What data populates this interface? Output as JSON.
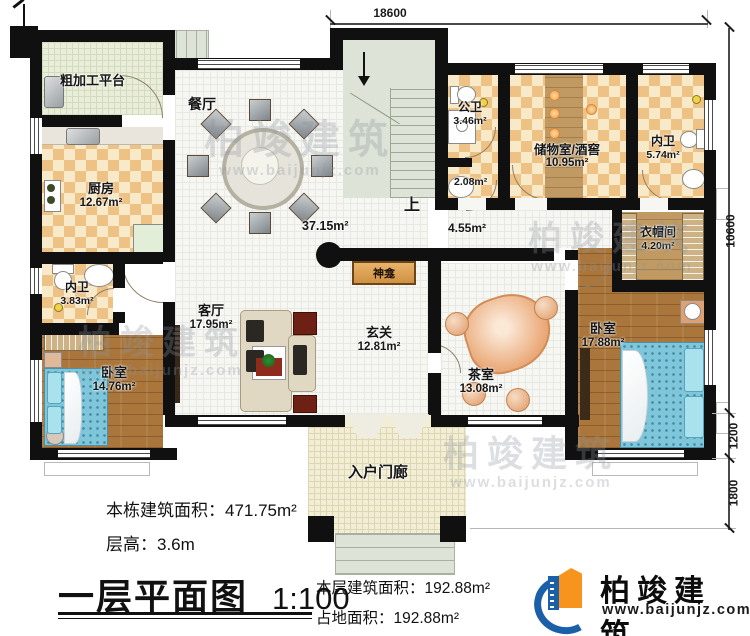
{
  "plan_name": "一层平面图",
  "dimensions": {
    "top": "18600",
    "side_main": "10600",
    "side_bay": "1200",
    "side_porch": "1800"
  },
  "rooms": {
    "rough_platform": {
      "name": "粗加工平台"
    },
    "dining": {
      "name": "餐厅",
      "area": "37.15m²"
    },
    "kitchen": {
      "name": "厨房",
      "area": "12.67m²"
    },
    "public_wc": {
      "name": "公卫",
      "area": "3.46m²",
      "area2": "2.08m²"
    },
    "storage": {
      "name": "储物室/酒窖",
      "area": "10.95m²"
    },
    "inner_wc_right": {
      "name": "内卫",
      "area": "5.74m²"
    },
    "cloakroom": {
      "name": "衣帽间",
      "area": "4.20m²"
    },
    "inner_wc_left": {
      "name": "内卫",
      "area": "3.83m²"
    },
    "living": {
      "name": "客厅",
      "area": "17.95m²"
    },
    "foyer": {
      "name": "玄关",
      "area": "12.81m²"
    },
    "tea_room": {
      "name": "茶室",
      "area": "13.08m²"
    },
    "bedroom_left": {
      "name": "卧室",
      "area": "14.76m²"
    },
    "bedroom_right": {
      "name": "卧室",
      "area": "17.88m²"
    },
    "porch": {
      "name": "入户门廊"
    },
    "shrine": {
      "name": "神龛"
    },
    "corridor": {
      "area": "4.55m²"
    },
    "stairs": {
      "label": "上"
    }
  },
  "title_block": {
    "building_total": "本栋建筑面积：471.75m²",
    "floor_height": "层高：3.6m",
    "plan_title": "一层平面图",
    "scale": "1:100",
    "floor_area": "本层建筑面积：192.88m²",
    "footprint": "占地面积：192.88m²"
  },
  "logo": {
    "name": "柏竣建筑",
    "url": "www.baijunjz.com"
  },
  "watermark": {
    "name": "柏竣建筑",
    "url": "www.baijunjz.com"
  },
  "colors": {
    "wall": "#101010",
    "checker_tile": "#eec185",
    "wood_floor": "#aa763c",
    "ceramic_tile": "#f6f6f3",
    "bed": "#7fc6da",
    "stairs": "#dde3d6",
    "porch": "#f2eed6",
    "platform": "#e9edd9",
    "logo_blue": "#1b5fa8",
    "logo_orange": "#f7941d",
    "shrine": "#cf9142"
  }
}
